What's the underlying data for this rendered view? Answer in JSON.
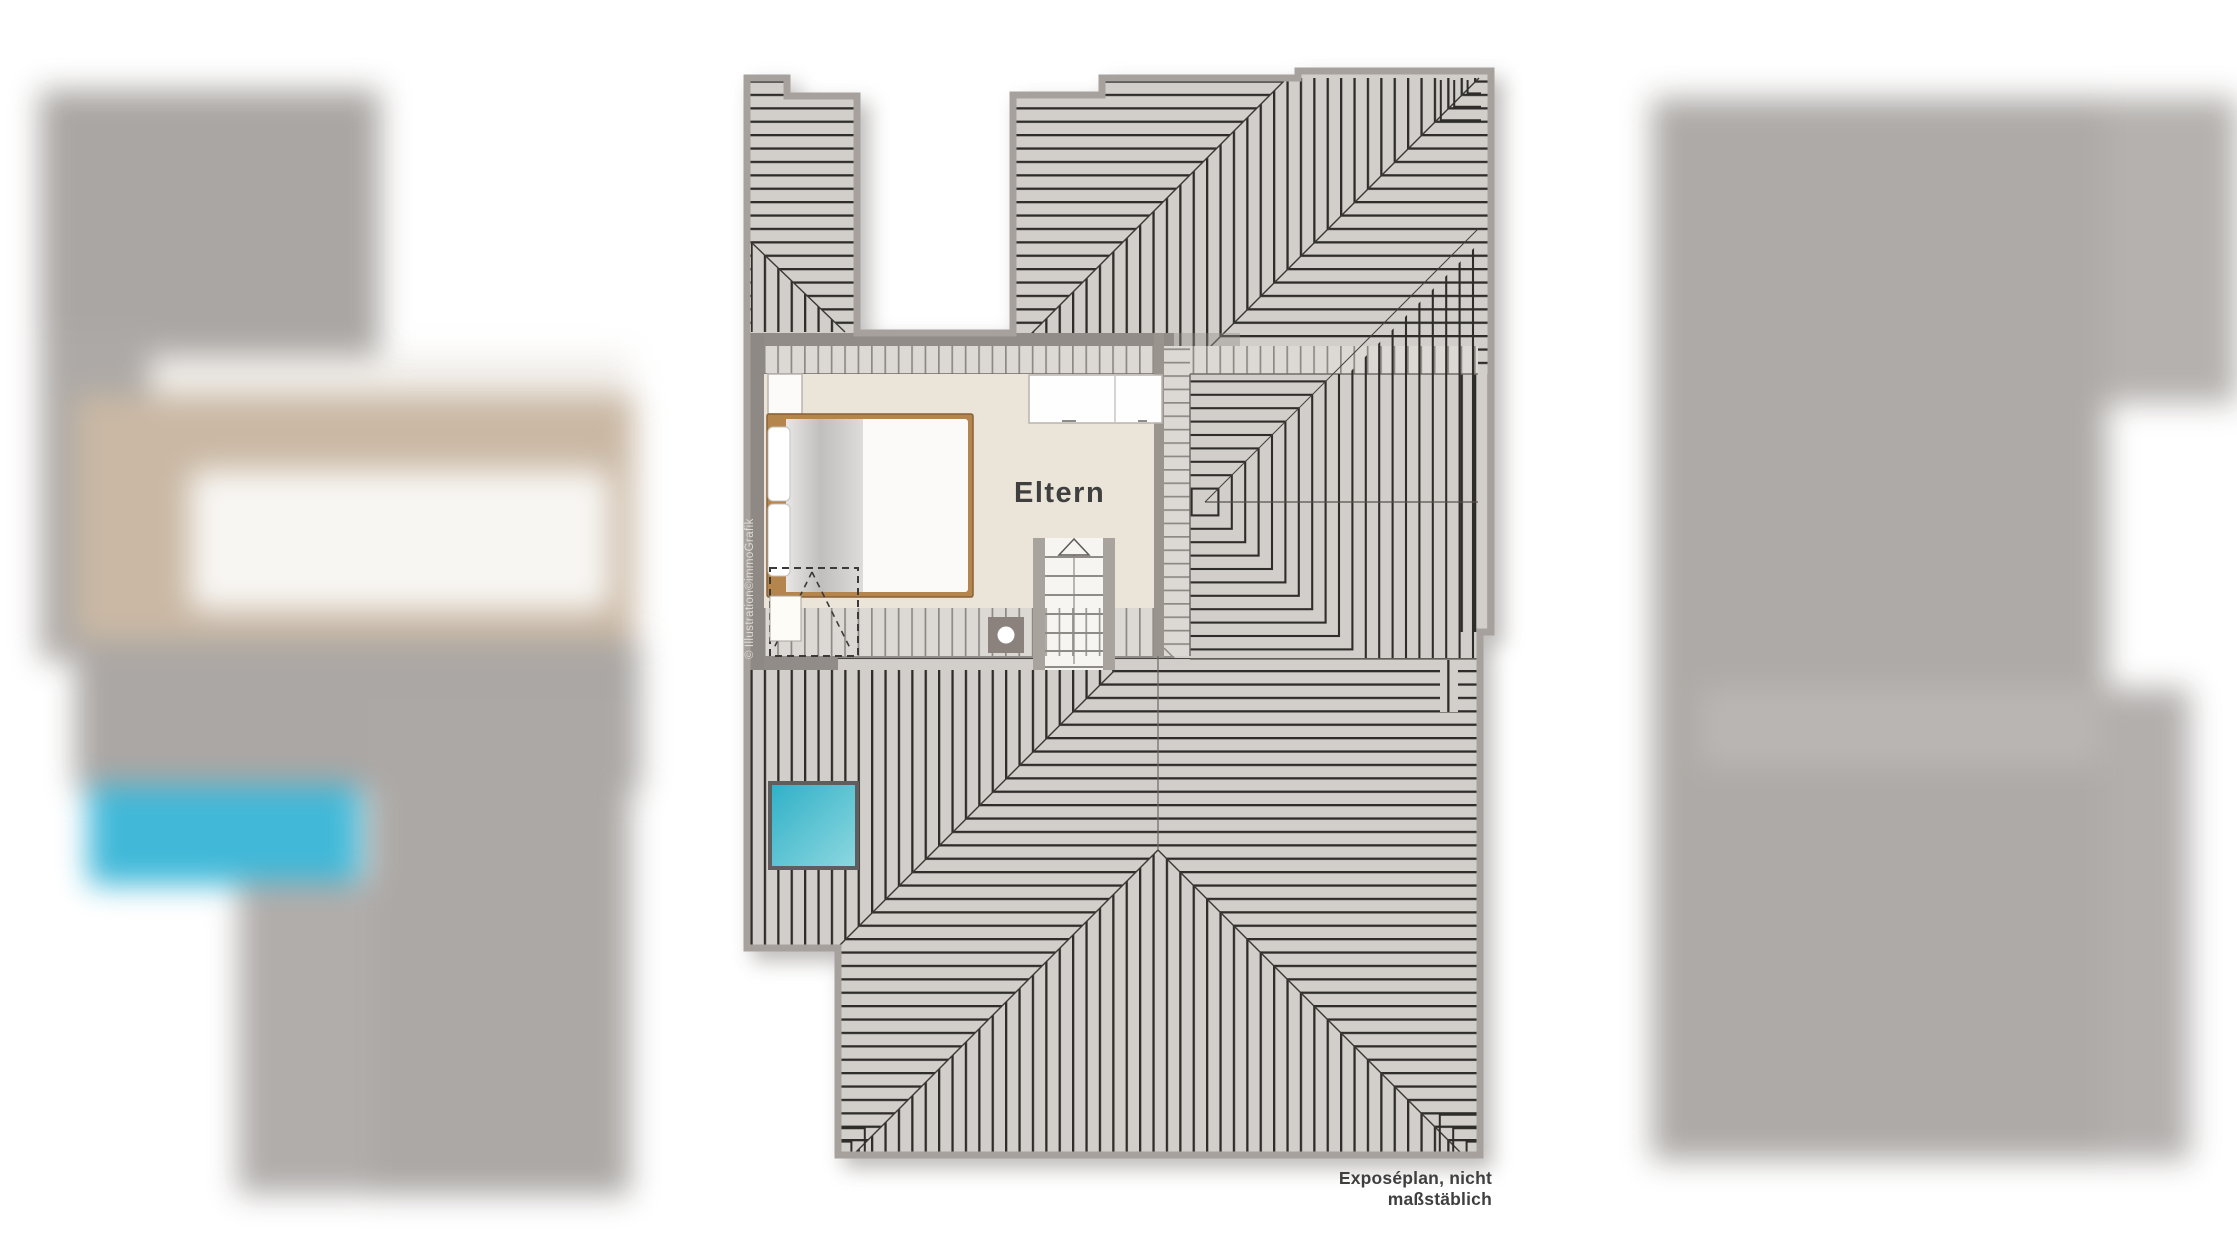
{
  "document": {
    "type": "real-estate floor plan (attic storey / Dachgeschoss)",
    "caption": "Exposéplan, nicht maßstäblich",
    "credit": "Illustration©immoGrafik",
    "credit_glyph": "©"
  },
  "rooms": [
    {
      "label": "Eltern"
    }
  ],
  "furniture": [
    {
      "name": "double-bed"
    },
    {
      "name": "wardrobe"
    },
    {
      "name": "nightstand"
    },
    {
      "name": "staircase-up"
    },
    {
      "name": "chimney"
    },
    {
      "name": "skylight-window"
    },
    {
      "name": "clearance-dashed-zone"
    }
  ],
  "colors": {
    "page_bg": "#ffffff",
    "roof_fill": "#d2cfcb",
    "roof_line": "#2f2d2a",
    "eave_fill": "#dcd8d4",
    "eave_line": "#8d8984",
    "wall_band": "#928c88",
    "outline_edge": "#a7a19d",
    "floor_beige": "#eae4d9",
    "bed_frame_tan": "#b5854e",
    "skylight_teal": "#3ab6d7",
    "chimney_gray": "#8b827d",
    "label_text": "#3f3f3f",
    "credit_text": "#dedbd7"
  }
}
